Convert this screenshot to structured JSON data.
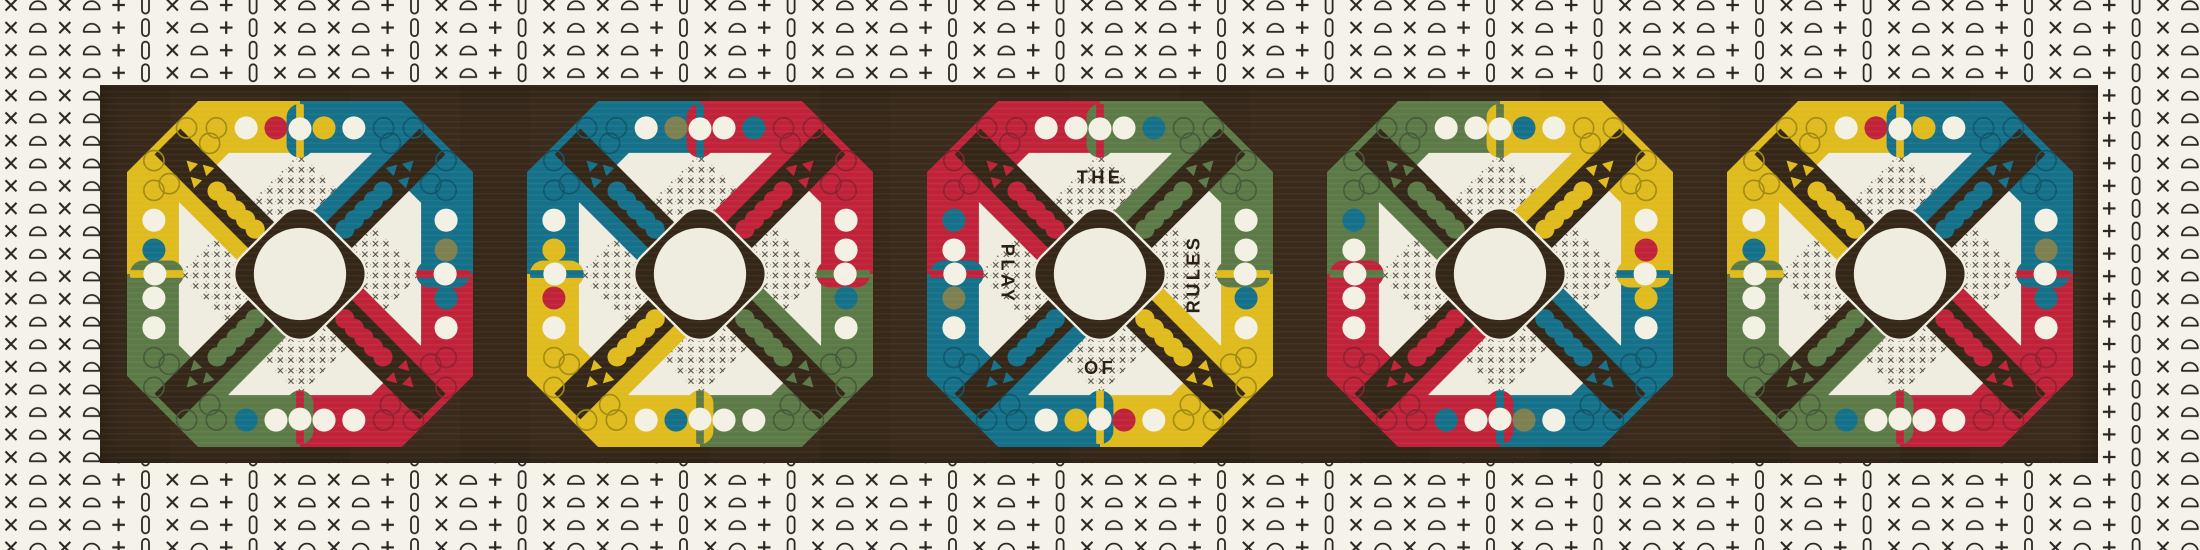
{
  "artwork": {
    "phrase": "THE PLAY OF RULES",
    "center_text": {
      "top": "THE",
      "left": "PLAY",
      "bottom": "OF",
      "right": "RULES"
    },
    "description": "Five four-color pegboard game boards on a dark wood panel with stitch-symbol border"
  },
  "palette": {
    "background": "#f4f2e9",
    "symbol": "#2b2823",
    "panel": "#3a2b1c",
    "board_dark": "#342718",
    "cream": "#efece0",
    "red": "#c02339",
    "teal": "#15718a",
    "yellow": "#dfbb1e",
    "green": "#5c7a47",
    "olive": "#7d8050",
    "white": "#f3f0e4",
    "text": "#2a2114",
    "crosshatch": "#4a4538",
    "outline_dark": {
      "red": "#8e1f30",
      "teal": "#0f566b",
      "yellow": "#a18a12",
      "green": "#45593a"
    }
  },
  "border_pattern": {
    "sequence": [
      "x",
      "dome",
      "x",
      "dome",
      "plus",
      "pill",
      "x",
      "dome",
      "plus",
      "pill"
    ],
    "symbol_names": [
      "x-stitch-icon",
      "dome-stitch-icon",
      "plus-stitch-icon",
      "pill-stitch-icon"
    ]
  },
  "boards": [
    {
      "name": "board-1",
      "quadrants": {
        "tl": "yellow",
        "tr": "teal",
        "br": "red",
        "bl": "green"
      },
      "pegs": {
        "top": [
          null,
          null,
          "white",
          "red",
          "yellow",
          "white",
          null,
          null
        ],
        "right": [
          null,
          null,
          "white",
          "olive",
          "teal",
          "white",
          null,
          null
        ],
        "bottom": [
          null,
          null,
          "teal",
          "white",
          "white",
          "white",
          null,
          null
        ],
        "left": [
          null,
          null,
          "white",
          "teal",
          "white",
          "white",
          null,
          null
        ]
      },
      "words": null
    },
    {
      "name": "board-2",
      "quadrants": {
        "tl": "teal",
        "tr": "red",
        "br": "green",
        "bl": "yellow"
      },
      "pegs": {
        "top": [
          null,
          null,
          "white",
          "olive",
          "white",
          "teal",
          null,
          null
        ],
        "right": [
          null,
          null,
          "white",
          "white",
          "teal",
          "white",
          null,
          null
        ],
        "bottom": [
          null,
          null,
          "white",
          "teal",
          "white",
          "white",
          null,
          null
        ],
        "left": [
          null,
          null,
          "white",
          "yellow",
          "red",
          "white",
          null,
          null
        ]
      },
      "words": null
    },
    {
      "name": "board-3",
      "quadrants": {
        "tl": "red",
        "tr": "green",
        "br": "yellow",
        "bl": "teal"
      },
      "pegs": {
        "top": [
          null,
          null,
          "white",
          "white",
          "white",
          "teal",
          null,
          null
        ],
        "right": [
          null,
          null,
          "white",
          "white",
          "teal",
          "white",
          null,
          null
        ],
        "bottom": [
          null,
          null,
          "white",
          "yellow",
          "red",
          "white",
          null,
          null
        ],
        "left": [
          null,
          null,
          "teal",
          "white",
          "olive",
          "white",
          null,
          null
        ]
      },
      "words": {
        "top": "THE",
        "left": "PLAY",
        "bottom": "OF",
        "right": "RULES"
      }
    },
    {
      "name": "board-4",
      "quadrants": {
        "tl": "green",
        "tr": "yellow",
        "br": "teal",
        "bl": "red"
      },
      "pegs": {
        "top": [
          null,
          null,
          "white",
          "white",
          "teal",
          "white",
          null,
          null
        ],
        "right": [
          null,
          null,
          "white",
          "red",
          "yellow",
          "white",
          null,
          null
        ],
        "bottom": [
          null,
          null,
          "teal",
          "white",
          "olive",
          "white",
          null,
          null
        ],
        "left": [
          null,
          null,
          "teal",
          "white",
          "white",
          "white",
          null,
          null
        ]
      },
      "words": null
    },
    {
      "name": "board-5",
      "quadrants": {
        "tl": "yellow",
        "tr": "teal",
        "br": "red",
        "bl": "green"
      },
      "pegs": {
        "top": [
          null,
          null,
          "white",
          "red",
          "yellow",
          "white",
          null,
          null
        ],
        "right": [
          null,
          null,
          "white",
          "olive",
          "teal",
          "white",
          null,
          null
        ],
        "bottom": [
          null,
          null,
          "teal",
          "white",
          "white",
          "white",
          null,
          null
        ],
        "left": [
          null,
          null,
          "white",
          "teal",
          "white",
          "white",
          null,
          null
        ]
      },
      "words": null
    }
  ]
}
